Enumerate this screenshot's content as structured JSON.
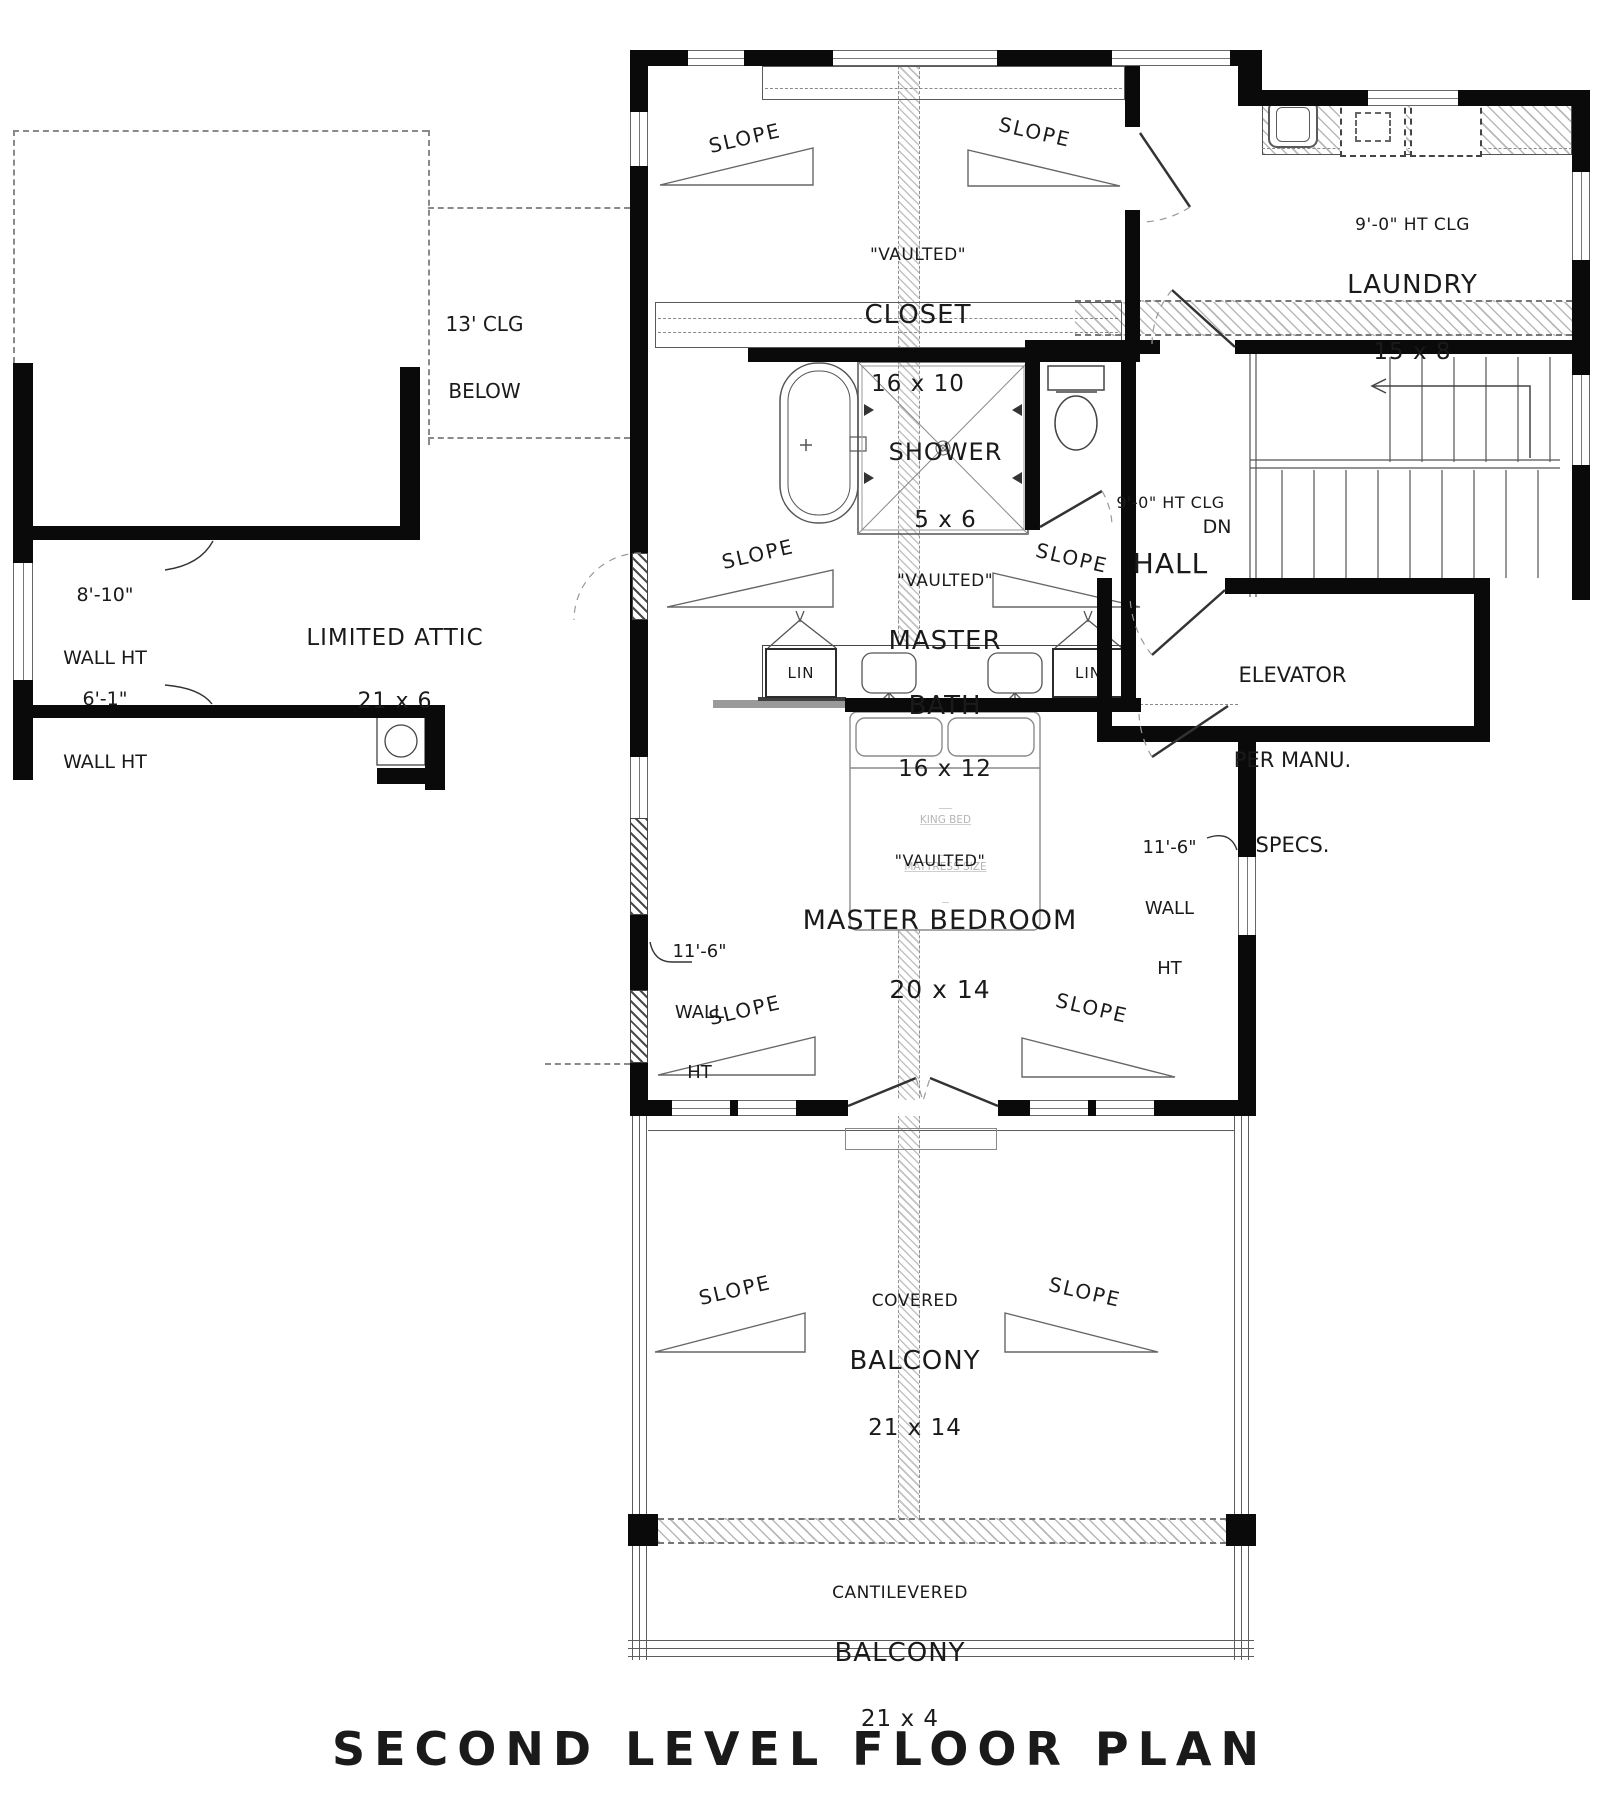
{
  "title": "SECOND LEVEL FLOOR PLAN",
  "labels": {
    "slope": "SLOPE",
    "dn": "DN",
    "lin": "LIN"
  },
  "rooms": {
    "closet": {
      "note": "\"VAULTED\"",
      "name": "CLOSET",
      "dims": "16 x 10"
    },
    "laundry": {
      "note": "9'-0\" HT CLG",
      "name": "LAUNDRY",
      "dims": "15 x 8"
    },
    "shower": {
      "name": "SHOWER",
      "dims": "5 x 6"
    },
    "master_bath": {
      "note": "\"VAULTED\"",
      "name1": "MASTER",
      "name2": "BATH",
      "dims": "16 x 12"
    },
    "hall": {
      "note": "9'-0\" HT CLG",
      "name": "HALL"
    },
    "master_bedroom": {
      "note": "\"VAULTED\"",
      "name": "MASTER BEDROOM",
      "dims": "20 x 14"
    },
    "limited_attic": {
      "name": "LIMITED ATTIC",
      "dims": "21 x 6"
    },
    "covered_balcony": {
      "name1": "COVERED",
      "name2": "BALCONY",
      "dims": "21 x 14"
    },
    "cantilevered_balcony": {
      "name1": "CANTILEVERED",
      "name2": "BALCONY",
      "dims": "21 x 4"
    },
    "elevator": {
      "line1": "ELEVATOR",
      "line2": "PER MANU.",
      "line3": "SPECS."
    }
  },
  "annotations": {
    "clg_below1": "13' CLG",
    "clg_below2": "BELOW",
    "wall_ht_8_10_1": "8'-10\"",
    "wall_ht_8_10_2": "WALL HT",
    "wall_ht_6_1_1": "6'-1\"",
    "wall_ht_6_1_2": "WALL HT",
    "wall_ht_11_6_1": "11'-6\"",
    "wall_ht_11_6_2": "WALL",
    "wall_ht_11_6_3": "HT",
    "king_bed_1": "KING BED",
    "king_bed_2": "MATTRESS SIZE"
  }
}
